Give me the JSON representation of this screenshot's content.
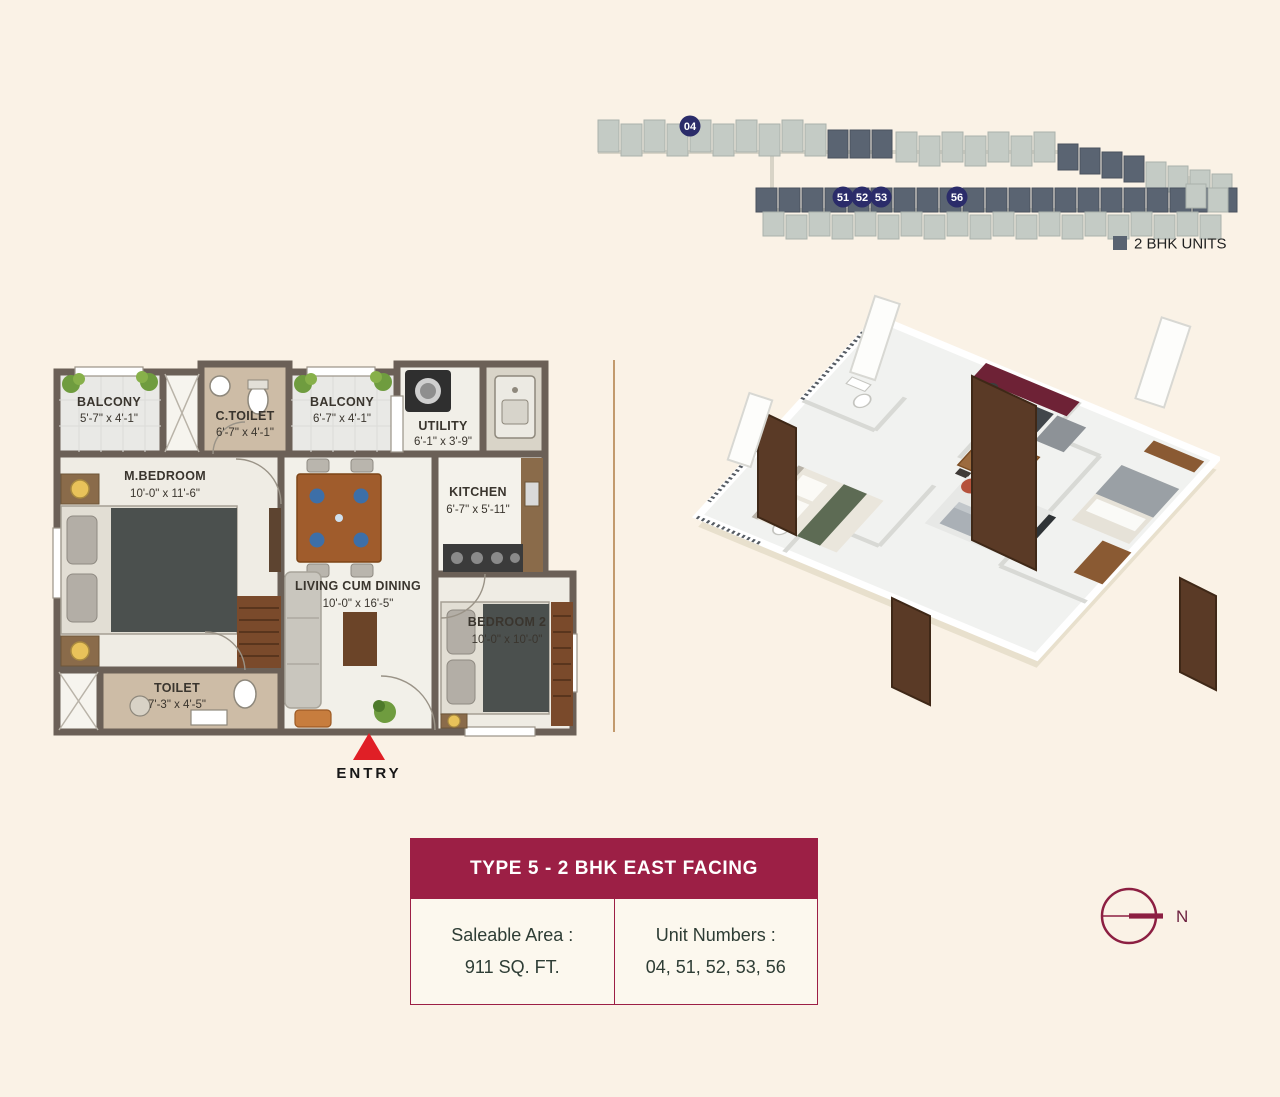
{
  "site_map": {
    "unit_markers": [
      "04",
      "51",
      "52",
      "53",
      "56"
    ],
    "legend_label": "2 BHK UNITS"
  },
  "plan2d": {
    "rooms": {
      "balcony1": {
        "name": "BALCONY",
        "dims": "5'-7\" x 4'-1\""
      },
      "c_toilet": {
        "name": "C.TOILET",
        "dims": "6'-7\" x 4'-1\""
      },
      "balcony2": {
        "name": "BALCONY",
        "dims": "6'-7\" x 4'-1\""
      },
      "utility": {
        "name": "UTILITY",
        "dims": "6'-1\" x 3'-9\""
      },
      "m_bedroom": {
        "name": "M.BEDROOM",
        "dims": "10'-0\" x 11'-6\""
      },
      "kitchen": {
        "name": "KITCHEN",
        "dims": "6'-7\" x 5'-11\""
      },
      "living": {
        "name": "LIVING CUM DINING",
        "dims": "10'-0\" x 16'-5\""
      },
      "bedroom2": {
        "name": "BEDROOM 2",
        "dims": "10'-0\" x 10'-0\""
      },
      "toilet": {
        "name": "TOILET",
        "dims": "7'-3\" x 4'-5\""
      }
    },
    "entry_label": "ENTRY"
  },
  "info_box": {
    "title": "TYPE 5 - 2 BHK EAST FACING",
    "saleable_area_label": "Saleable Area :",
    "saleable_area_value": "911 SQ. FT.",
    "unit_numbers_label": "Unit Numbers :",
    "unit_numbers_value": "04, 51, 52, 53, 56"
  },
  "compass": {
    "north_label": "N"
  },
  "colors": {
    "maroon": "#9c1f45",
    "navy_marker": "#2b2c6a",
    "dark_unit": "#5a6472",
    "light_unit": "#c4cbc5",
    "entry_red": "#e01f26",
    "wall": "#6b6057"
  }
}
